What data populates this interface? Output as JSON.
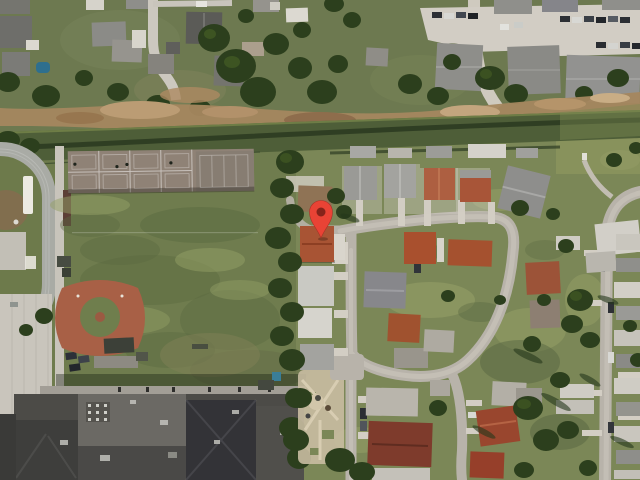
{
  "map": {
    "view_type": "satellite-imagery",
    "description": "Aerial view: school campus with track, courts, field and baseball diamond on the left; mobile home park streets on the right; residential strip and parking lot on top; dirt trail and drainage canal crossing horizontally; red map pin marking a terracotta-roof home.",
    "marker": {
      "label": "selected-location",
      "pin_color": "#E94335",
      "pin_border": "#A83227",
      "dot_color": "#85231A",
      "tip_x": 321,
      "tip_y": 238
    },
    "palette": {
      "grass_north": "#6d7950",
      "grass_field": "#6f7c4e",
      "grass_park": "#7b8757",
      "pavement": "#b8b3aa",
      "concrete": "#d2cdc4",
      "dirt_road": "#a5875f",
      "canal_water": "#4e5e38",
      "tree_canopy": "#2c3f1d",
      "roof_gray": "#9a9a96",
      "roof_white": "#d5d2ca",
      "roof_terracotta": "#a85434",
      "roof_dark_red": "#7e3b2c",
      "school_roof": "#4c4b47",
      "sports_court": "#8f8276",
      "running_track": "#a9aba5",
      "baseball_clay": "#a86046",
      "marker_red": "#E94335"
    },
    "features": [
      {
        "name": "residential-neighborhood-north"
      },
      {
        "name": "apartment-parking-lot"
      },
      {
        "name": "dirt-trail"
      },
      {
        "name": "drainage-canal"
      },
      {
        "name": "running-track"
      },
      {
        "name": "sport-courts"
      },
      {
        "name": "athletic-field"
      },
      {
        "name": "baseball-diamond"
      },
      {
        "name": "school-building"
      },
      {
        "name": "playground"
      },
      {
        "name": "mobile-home-park"
      },
      {
        "name": "park-loop-street"
      },
      {
        "name": "east-street"
      },
      {
        "name": "location-marker"
      }
    ]
  }
}
